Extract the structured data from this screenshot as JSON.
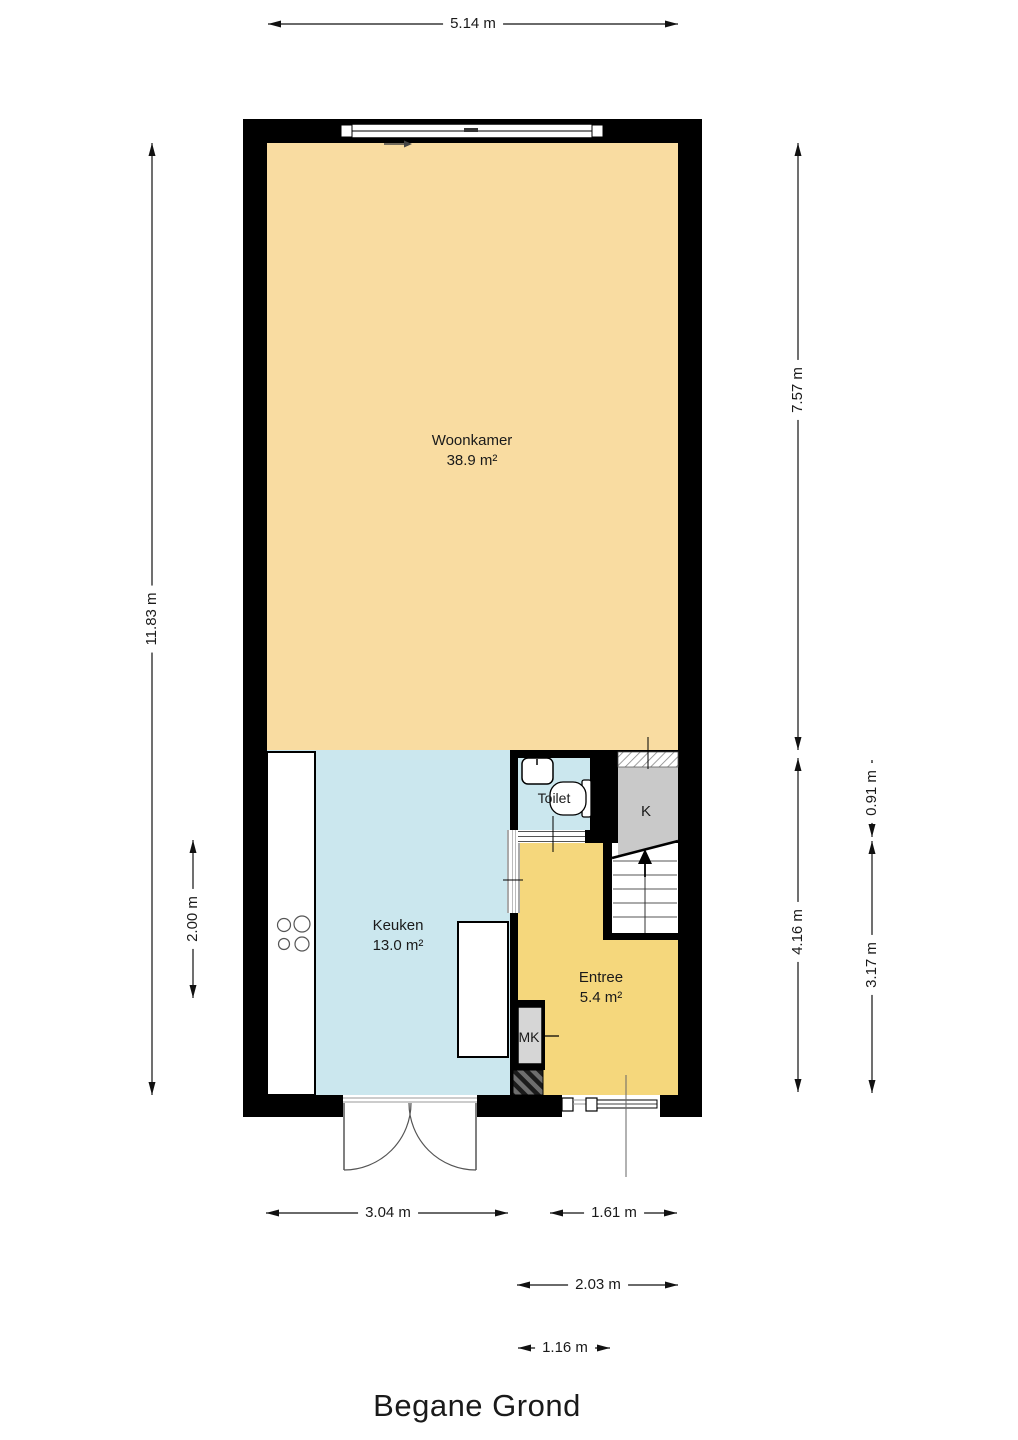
{
  "title": "Begane Grond",
  "rooms": {
    "woonkamer": {
      "name": "Woonkamer",
      "area": "38.9 m²"
    },
    "keuken": {
      "name": "Keuken",
      "area": "13.0 m²"
    },
    "entree": {
      "name": "Entree",
      "area": "5.4 m²"
    },
    "toilet": {
      "name": "Toilet"
    },
    "kast": {
      "name": "K"
    },
    "meterkast": {
      "name": "MK"
    }
  },
  "dimensions": {
    "top_width": "5.14 m",
    "left_total_height": "11.83 m",
    "left_kitchen": "2.00 m",
    "right_living": "7.57 m",
    "right_toilet": "0.91 m",
    "right_lower": "4.16 m",
    "right_hall": "3.17 m",
    "bottom_kitchen": "3.04 m",
    "bottom_entree": "1.61 m",
    "bottom_entree_wide": "2.03 m",
    "bottom_door": "1.16 m"
  },
  "colors": {
    "living_room": "#F9DCA1",
    "kitchen_toilet": "#CBE7EE",
    "entree": "#F5D77C",
    "closet": "#C9C9C9",
    "meter_closet": "#D6D6D6",
    "walls": "#000000"
  }
}
